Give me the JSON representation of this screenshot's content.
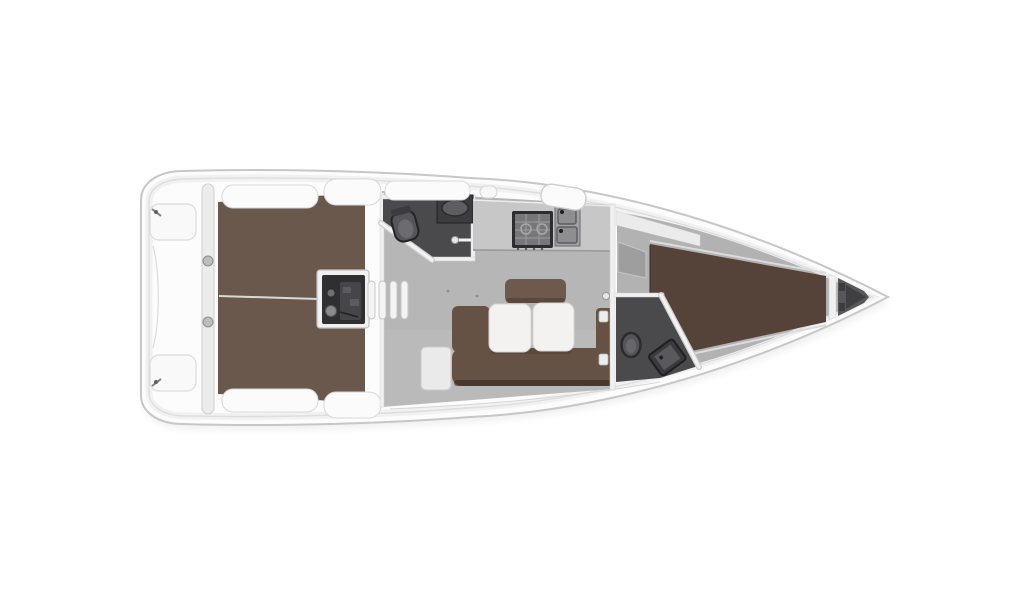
{
  "page": {
    "kind": "yacht-deck-plan",
    "description": "Top-down interior layout plan of a sailing yacht, bow pointing right, stern at left, rendered on a plain white background with no text labels."
  },
  "boat": {
    "orientation": {
      "bow": "right",
      "stern": "left"
    },
    "areas": {
      "swim_platform": {
        "label": "Stern swim platform with two transom seats and cleats"
      },
      "cockpit": {
        "label": "Cockpit with teak sole split by centerline",
        "features": [
          "port bench cushions",
          "starboard bench cushions",
          "steering / engine console",
          "transom pillar with two winch knobs"
        ]
      },
      "companionway": {
        "label": "Companionway steps (four treads) down to salon"
      },
      "aft_head": {
        "label": "Aft head compartment",
        "features": [
          "toilet",
          "vanity sink",
          "angled door with handle"
        ]
      },
      "galley": {
        "label": "Galley counter",
        "features": [
          "stove with burner grate",
          "double sink with faucets"
        ]
      },
      "salon": {
        "label": "Salon",
        "features": [
          "U-shaped settee",
          "folding table with two white leaves",
          "backrest cushion",
          "side stool seat"
        ]
      },
      "forward_head": {
        "label": "Forward head compartment",
        "features": [
          "toilet",
          "angled shower tray",
          "angled partition wall"
        ]
      },
      "forward_cabin": {
        "label": "Forward cabin",
        "features": [
          "V-berth double bed",
          "shelf band",
          "wardrobe block",
          "entry door with handle"
        ]
      },
      "anchor_locker": {
        "label": "Bow anchor locker behind bulkhead"
      },
      "deck": {
        "label": "Side decks and coachroof",
        "features": [
          "deck hatch",
          "deck locker boxes",
          "toe-rail inner line"
        ]
      }
    }
  },
  "colors": {
    "hull_fill": "#fcfcfc",
    "hull_outline": "#c7c7c7",
    "inner_line": "#dedede",
    "cockpit_teak": "#6b584d",
    "berth_brown": "#55433a",
    "settee_brown": "#665245",
    "backrest_brown": "#6e5a4d",
    "salon_floor": "#b6b6b6",
    "forward_floor": "#b2b2b2",
    "head_floor": "#4a4a4c",
    "counter_gray": "#c7c7c7",
    "fixture_dark": "#3c3c3e",
    "console_dark": "#2f2f31",
    "wall_white": "#f0f0f0",
    "bench_white": "#fbfbfb",
    "table_white": "#f3f2f0",
    "locker_gray": "#57575a",
    "wardrobe_gray": "#9e9e9e"
  }
}
